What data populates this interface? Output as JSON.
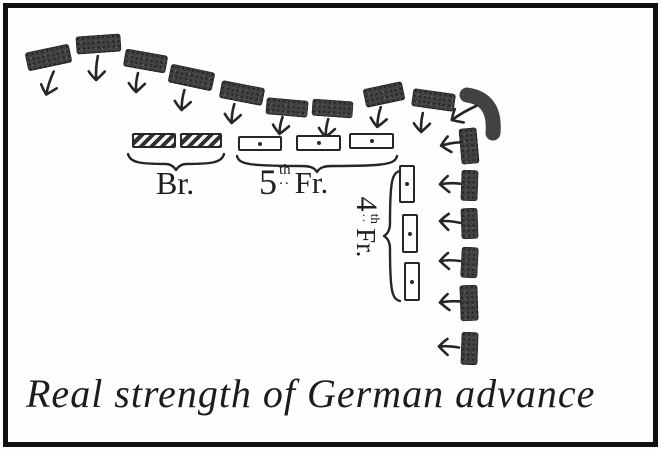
{
  "meta": {
    "caption": "Real strength of German advance",
    "figure_type": "hand-drawn military diagram"
  },
  "colors": {
    "ink": "#262626",
    "unit_fill": "#424242",
    "paper": "#fefefe",
    "frame": "#101010"
  },
  "labels": {
    "british": "Br.",
    "french_5th": {
      "num": "5",
      "sup": "th",
      "dots": "..",
      "name": "Fr."
    },
    "french_4th": {
      "num": "4",
      "sup": "th",
      "dots": "..",
      "name": "Fr."
    }
  },
  "german_units": {
    "top_row": [
      {
        "x": 26,
        "y": 48,
        "w": 45,
        "h": 19,
        "rot": -12,
        "arrow": {
          "x": 38,
          "y": 70,
          "rot": 18,
          "len": 22
        }
      },
      {
        "x": 76,
        "y": 35,
        "w": 45,
        "h": 18,
        "rot": -4,
        "arrow": {
          "x": 85,
          "y": 55,
          "rot": 4,
          "len": 22
        }
      },
      {
        "x": 124,
        "y": 52,
        "w": 43,
        "h": 18,
        "rot": 10,
        "arrow": {
          "x": 125,
          "y": 72,
          "rot": 6,
          "len": 17
        }
      },
      {
        "x": 169,
        "y": 68,
        "w": 45,
        "h": 19,
        "rot": 12,
        "arrow": {
          "x": 171,
          "y": 89,
          "rot": 8,
          "len": 18
        }
      },
      {
        "x": 220,
        "y": 84,
        "w": 44,
        "h": 18,
        "rot": 11,
        "arrow": {
          "x": 221,
          "y": 103,
          "rot": 8,
          "len": 17
        }
      },
      {
        "x": 266,
        "y": 99,
        "w": 42,
        "h": 17,
        "rot": 5,
        "arrow": {
          "x": 269,
          "y": 116,
          "rot": 10,
          "len": 15
        }
      },
      {
        "x": 312,
        "y": 100,
        "w": 41,
        "h": 17,
        "rot": 4,
        "arrow": {
          "x": 315,
          "y": 118,
          "rot": 8,
          "len": 16
        }
      },
      {
        "x": 364,
        "y": 85,
        "w": 40,
        "h": 19,
        "rot": -12,
        "arrow": {
          "x": 367,
          "y": 106,
          "rot": 10,
          "len": 18
        }
      },
      {
        "x": 412,
        "y": 91,
        "w": 43,
        "h": 18,
        "rot": 8,
        "arrow": {
          "x": 410,
          "y": 112,
          "rot": 5,
          "len": 17
        }
      }
    ],
    "corner": {
      "x": 456,
      "y": 86,
      "arrow": {
        "x": 452,
        "y": 98,
        "rot": 60,
        "len": 26
      }
    },
    "right_column": [
      {
        "x": 460,
        "y": 128,
        "w": 18,
        "h": 36,
        "rot": -5,
        "arrow": {
          "x": 439,
          "y": 133,
          "rot": 80,
          "len": 18
        }
      },
      {
        "x": 461,
        "y": 170,
        "w": 17,
        "h": 31,
        "rot": 2,
        "arrow": {
          "x": 438,
          "y": 173,
          "rot": 88,
          "len": 18
        }
      },
      {
        "x": 461,
        "y": 208,
        "w": 17,
        "h": 31,
        "rot": -2,
        "arrow": {
          "x": 438,
          "y": 211,
          "rot": 95,
          "len": 18
        }
      },
      {
        "x": 461,
        "y": 247,
        "w": 17,
        "h": 31,
        "rot": 3,
        "arrow": {
          "x": 438,
          "y": 250,
          "rot": 90,
          "len": 18
        }
      },
      {
        "x": 460,
        "y": 285,
        "w": 18,
        "h": 36,
        "rot": -2,
        "arrow": {
          "x": 438,
          "y": 291,
          "rot": 87,
          "len": 18
        }
      },
      {
        "x": 461,
        "y": 332,
        "w": 17,
        "h": 33,
        "rot": 2,
        "arrow": {
          "x": 437,
          "y": 336,
          "rot": 93,
          "len": 18
        }
      }
    ]
  },
  "allied_units": {
    "british_boxes": [
      {
        "x": 132,
        "y": 133,
        "w": 44,
        "h": 15
      },
      {
        "x": 180,
        "y": 133,
        "w": 42,
        "h": 15
      }
    ],
    "french5_boxes": [
      {
        "x": 238,
        "y": 136,
        "w": 44,
        "h": 15
      },
      {
        "x": 296,
        "y": 135,
        "w": 45,
        "h": 16
      },
      {
        "x": 349,
        "y": 133,
        "w": 45,
        "h": 16
      }
    ],
    "french4_boxes": [
      {
        "x": 399,
        "y": 165,
        "w": 16,
        "h": 38
      },
      {
        "x": 402,
        "y": 214,
        "w": 16,
        "h": 39
      },
      {
        "x": 404,
        "y": 262,
        "w": 16,
        "h": 39
      }
    ],
    "braces": {
      "british": {
        "x": 126,
        "y": 150,
        "len": 100,
        "orient": "h"
      },
      "french5": {
        "x": 235,
        "y": 152,
        "len": 164,
        "orient": "h"
      },
      "french4": {
        "cx": 392,
        "cy": 235,
        "len": 134,
        "orient": "v"
      }
    }
  }
}
